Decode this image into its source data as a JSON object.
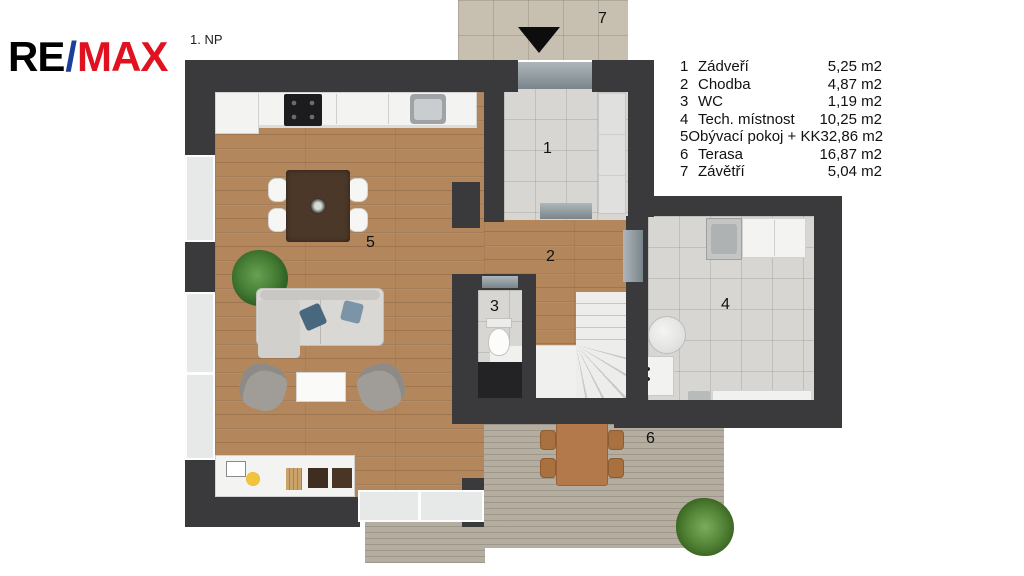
{
  "brand": {
    "re": "RE",
    "slash": "/",
    "max": "MAX"
  },
  "plan_label": "1. NP",
  "legend": {
    "items": [
      {
        "num": "1",
        "name": "Zádveří",
        "area": "5,25 m2"
      },
      {
        "num": "2",
        "name": "Chodba",
        "area": "4,87 m2"
      },
      {
        "num": "3",
        "name": "WC",
        "area": "1,19 m2"
      },
      {
        "num": "4",
        "name": "Tech. místnost",
        "area": "10,25 m2"
      },
      {
        "num": "5",
        "name": "Obývací pokoj + KK",
        "area": "32,86 m2"
      },
      {
        "num": "6",
        "name": "Terasa",
        "area": "16,87 m2"
      },
      {
        "num": "7",
        "name": "Závětří",
        "area": "5,04 m2"
      }
    ]
  },
  "rooms": {
    "entry": "1",
    "hallway": "2",
    "wc": "3",
    "tech": "4",
    "living_kitchen": "5",
    "terrace": "6",
    "porch": "7"
  },
  "colors": {
    "brand_red": "#e0121f",
    "brand_blue": "#1b3f9b",
    "wall": "#3a3a3c",
    "wood": "#b3865c",
    "tile": "#d7d6d2",
    "porch_tile": "#c7c0b1",
    "deck": "#b4ada0",
    "pillow_blue": "#48687f",
    "pillow_blue_light": "#7b94a8"
  }
}
